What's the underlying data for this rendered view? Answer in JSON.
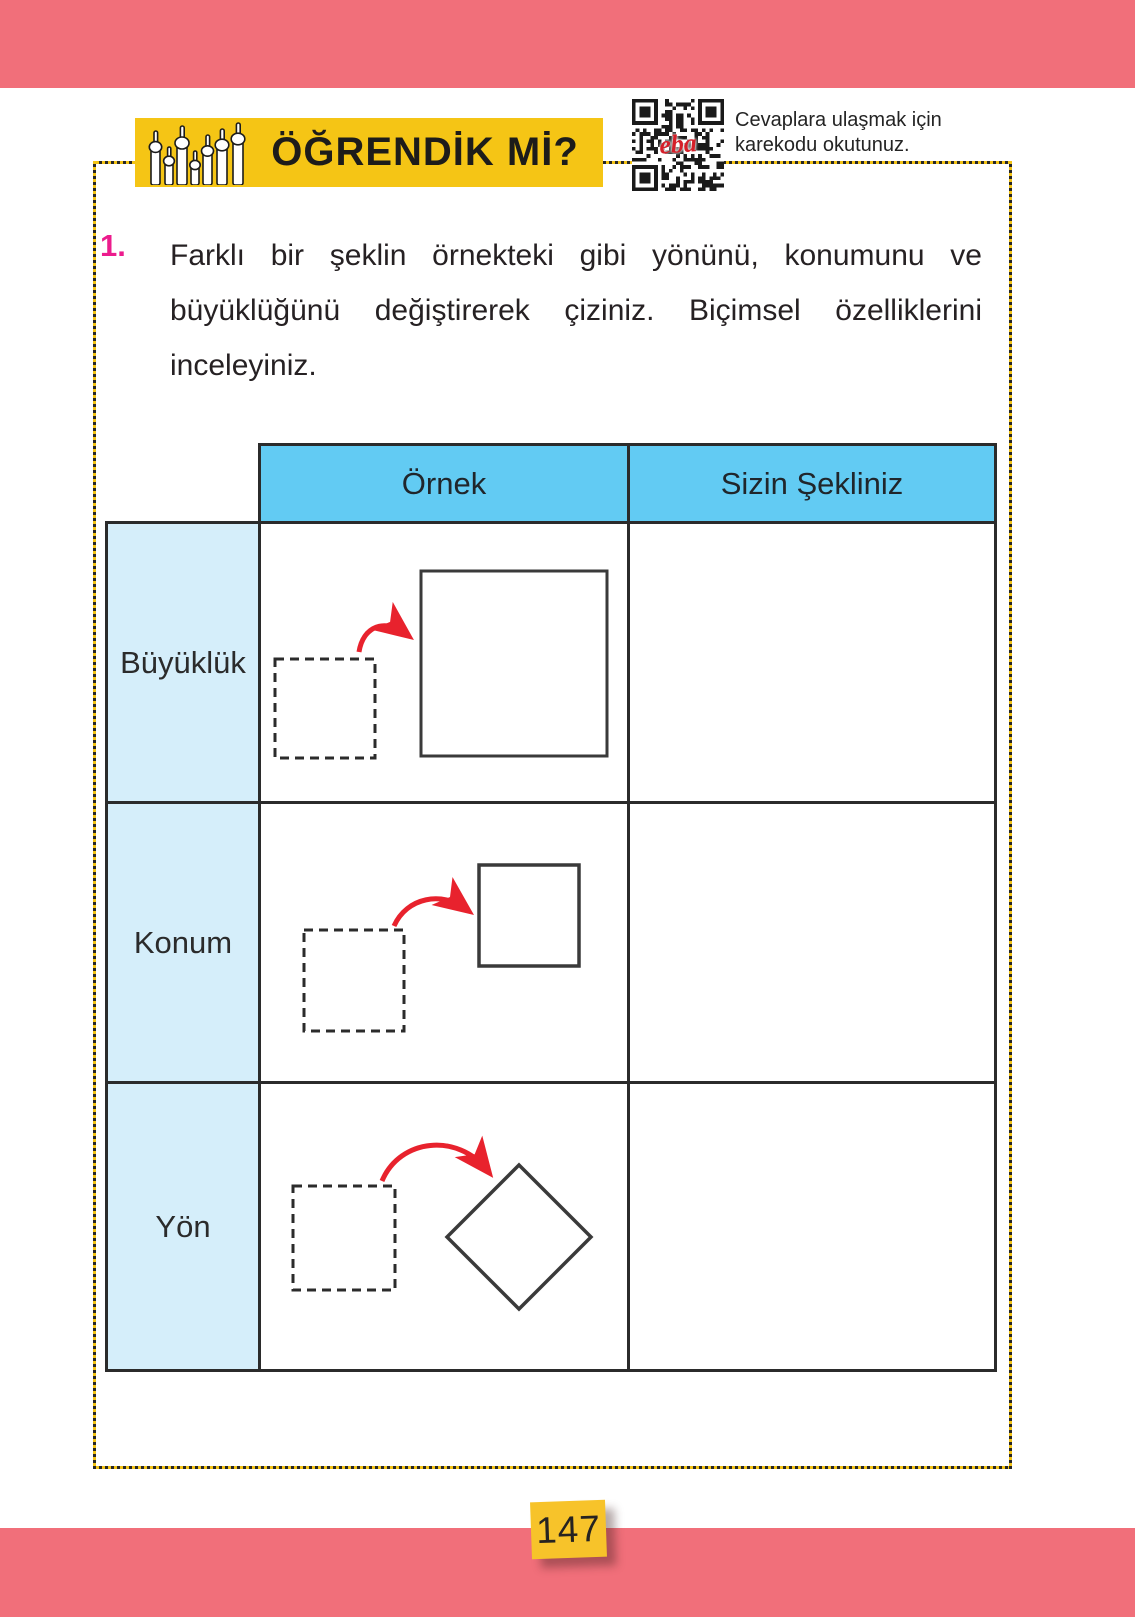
{
  "page": {
    "number": "147"
  },
  "header": {
    "title": "ÖĞRENDİK Mİ?",
    "qr_logo": "eba",
    "qr_caption_line1": "Cevaplara ulaşmak için",
    "qr_caption_line2": "karekodu okutunuz."
  },
  "question": {
    "number": "1.",
    "lines": [
      "Farklı bir şeklin örnekteki gibi yönünü, konumunu ve",
      "büyüklüğünü değiştirerek çiziniz. Biçimsel özelliklerini",
      "inceleyiniz."
    ]
  },
  "table": {
    "col_headers": [
      "Örnek",
      "Sizin Şekliniz"
    ],
    "row_labels": [
      "Büyüklük",
      "Konum",
      "Yön"
    ]
  },
  "colors": {
    "pink_bar": "#F16F7A",
    "banner_yellow": "#F5C515",
    "header_blue": "#62CBF3",
    "label_blue": "#D5EEFA",
    "arrow_red": "#E8222D",
    "question_number_pink": "#EC1C8D",
    "ink": "#2B2B2B"
  }
}
